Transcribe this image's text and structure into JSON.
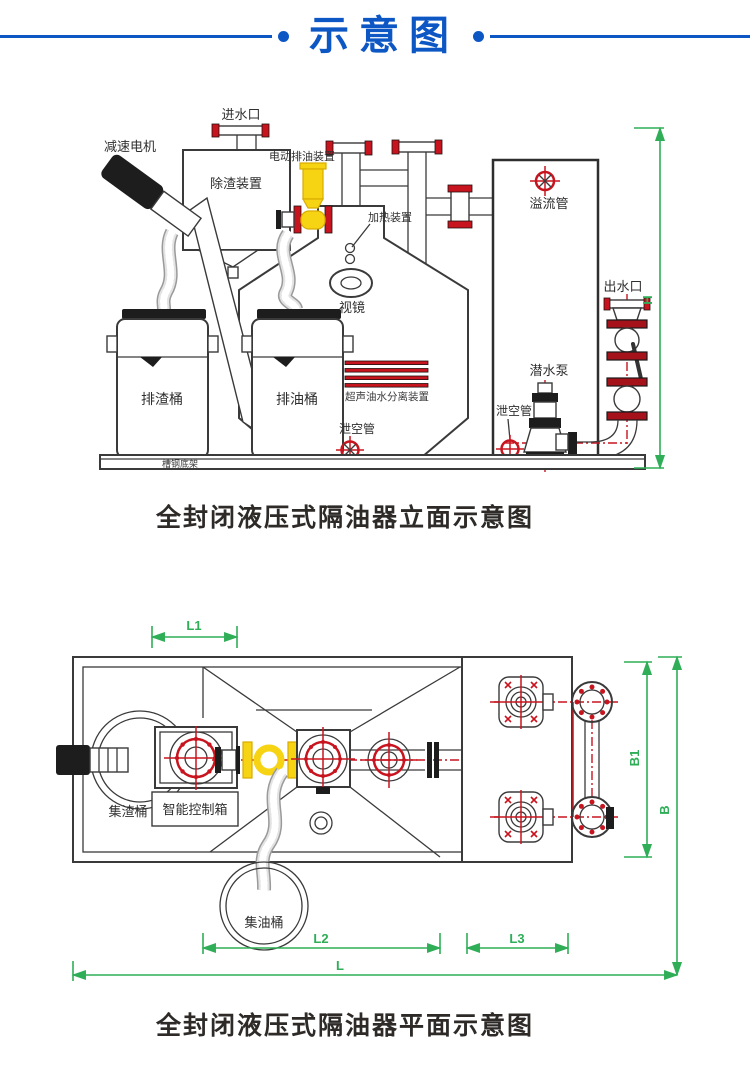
{
  "header": {
    "title": "示意图"
  },
  "elevation": {
    "labels": {
      "inlet": "进水口",
      "gear_motor": "减速电机",
      "deslag_device": "除渣装置",
      "electric_oil_discharge": "电动排油装置",
      "heating_device": "加热装置",
      "sight_glass": "视镜",
      "overflow_pipe": "溢流管",
      "water_outlet": "出水口",
      "slag_bucket": "排渣桶",
      "oil_bucket": "排油桶",
      "ultrasonic_separator": "超声油水分离装置",
      "drain_pipe_mid": "泄空管",
      "submersible_pump": "潜水泵",
      "drain_pipe_right": "泄空管",
      "base_frame": "槽钢底架"
    },
    "dimensions": {
      "h": "H"
    },
    "caption": "全封闭液压式隔油器立面示意图"
  },
  "plan": {
    "labels": {
      "slag_collect_bucket": "集渣桶",
      "control_box": "智能控制箱",
      "oil_collect_bucket": "集油桶"
    },
    "dimensions": {
      "l1": "L1",
      "l2": "L2",
      "l3": "L3",
      "l": "L",
      "b1": "B1",
      "b": "B"
    },
    "caption": "全封闭液压式隔油器平面示意图"
  },
  "colors": {
    "accent_blue": "#0d57c5",
    "dimension_green": "#2fae57",
    "flange_red": "#c8141e",
    "valve_yellow": "#f6d414",
    "line_dark": "#3a3a3a"
  }
}
